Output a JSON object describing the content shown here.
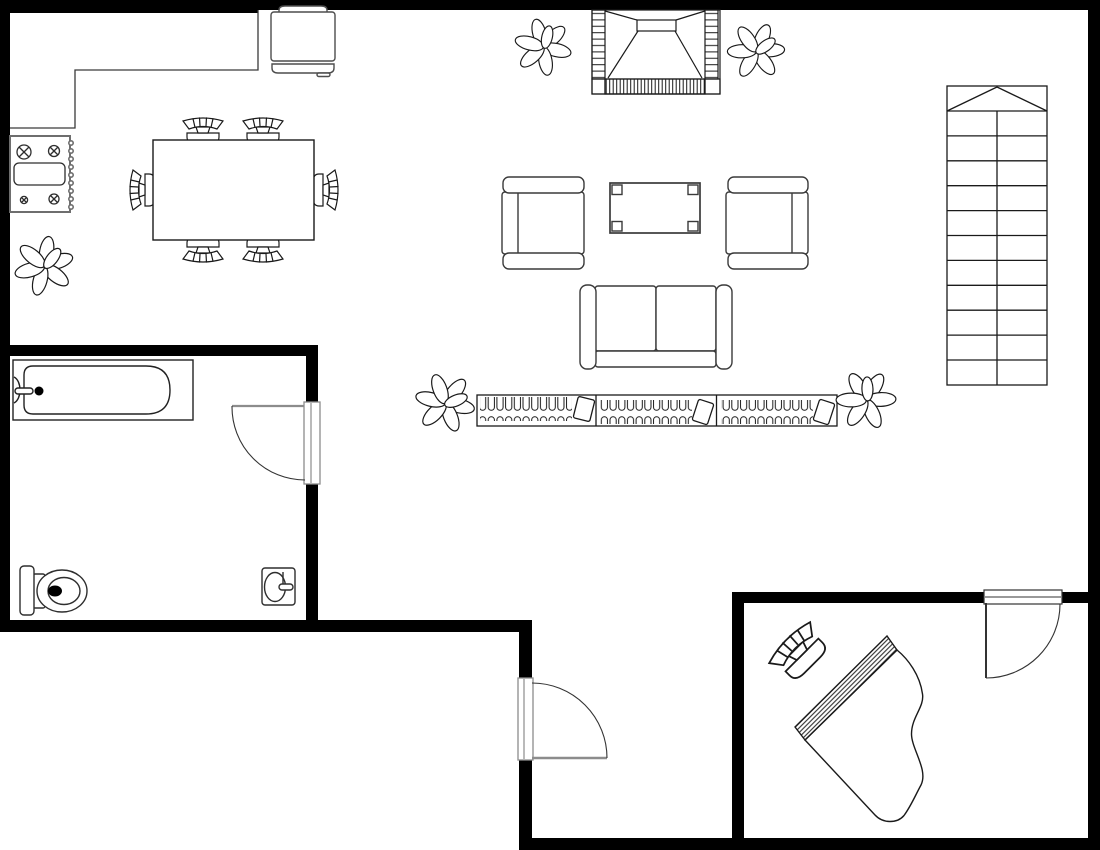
{
  "canvas": {
    "width": 1100,
    "height": 850,
    "background": "#ffffff"
  },
  "palette": {
    "wall": "#000000",
    "line": "#1a1a1a",
    "furniture_line": "#3a3a3a",
    "appliance_line": "#6e6e6e",
    "door_line": "#8c8c8c",
    "fill": "#ffffff"
  },
  "floor_plan": {
    "kind": "residential-floor-plan",
    "rooms": [
      {
        "name": "kitchen-dining-area",
        "elements": [
          "kitchen-counter",
          "refrigerator",
          "stove",
          "dining-table",
          "dining-chairs-x6",
          "plant"
        ]
      },
      {
        "name": "living-area",
        "elements": [
          "fireplace",
          "armchair-left",
          "armchair-right",
          "coffee-table",
          "sofa",
          "bookshelf",
          "stairs",
          "plants-x4"
        ]
      },
      {
        "name": "bathroom",
        "elements": [
          "bathtub",
          "toilet",
          "sink",
          "bathroom-door"
        ]
      },
      {
        "name": "entry",
        "elements": [
          "entry-door"
        ]
      },
      {
        "name": "piano-room",
        "elements": [
          "grand-piano",
          "piano-stool",
          "piano-room-door"
        ]
      }
    ],
    "doors": [
      {
        "name": "bathroom-door",
        "swing": "quarter-arc"
      },
      {
        "name": "entry-door",
        "swing": "quarter-arc"
      },
      {
        "name": "piano-room-door",
        "swing": "quarter-arc"
      }
    ],
    "stairs": {
      "steps": 12,
      "direction_arrow": "chevron-up"
    }
  }
}
